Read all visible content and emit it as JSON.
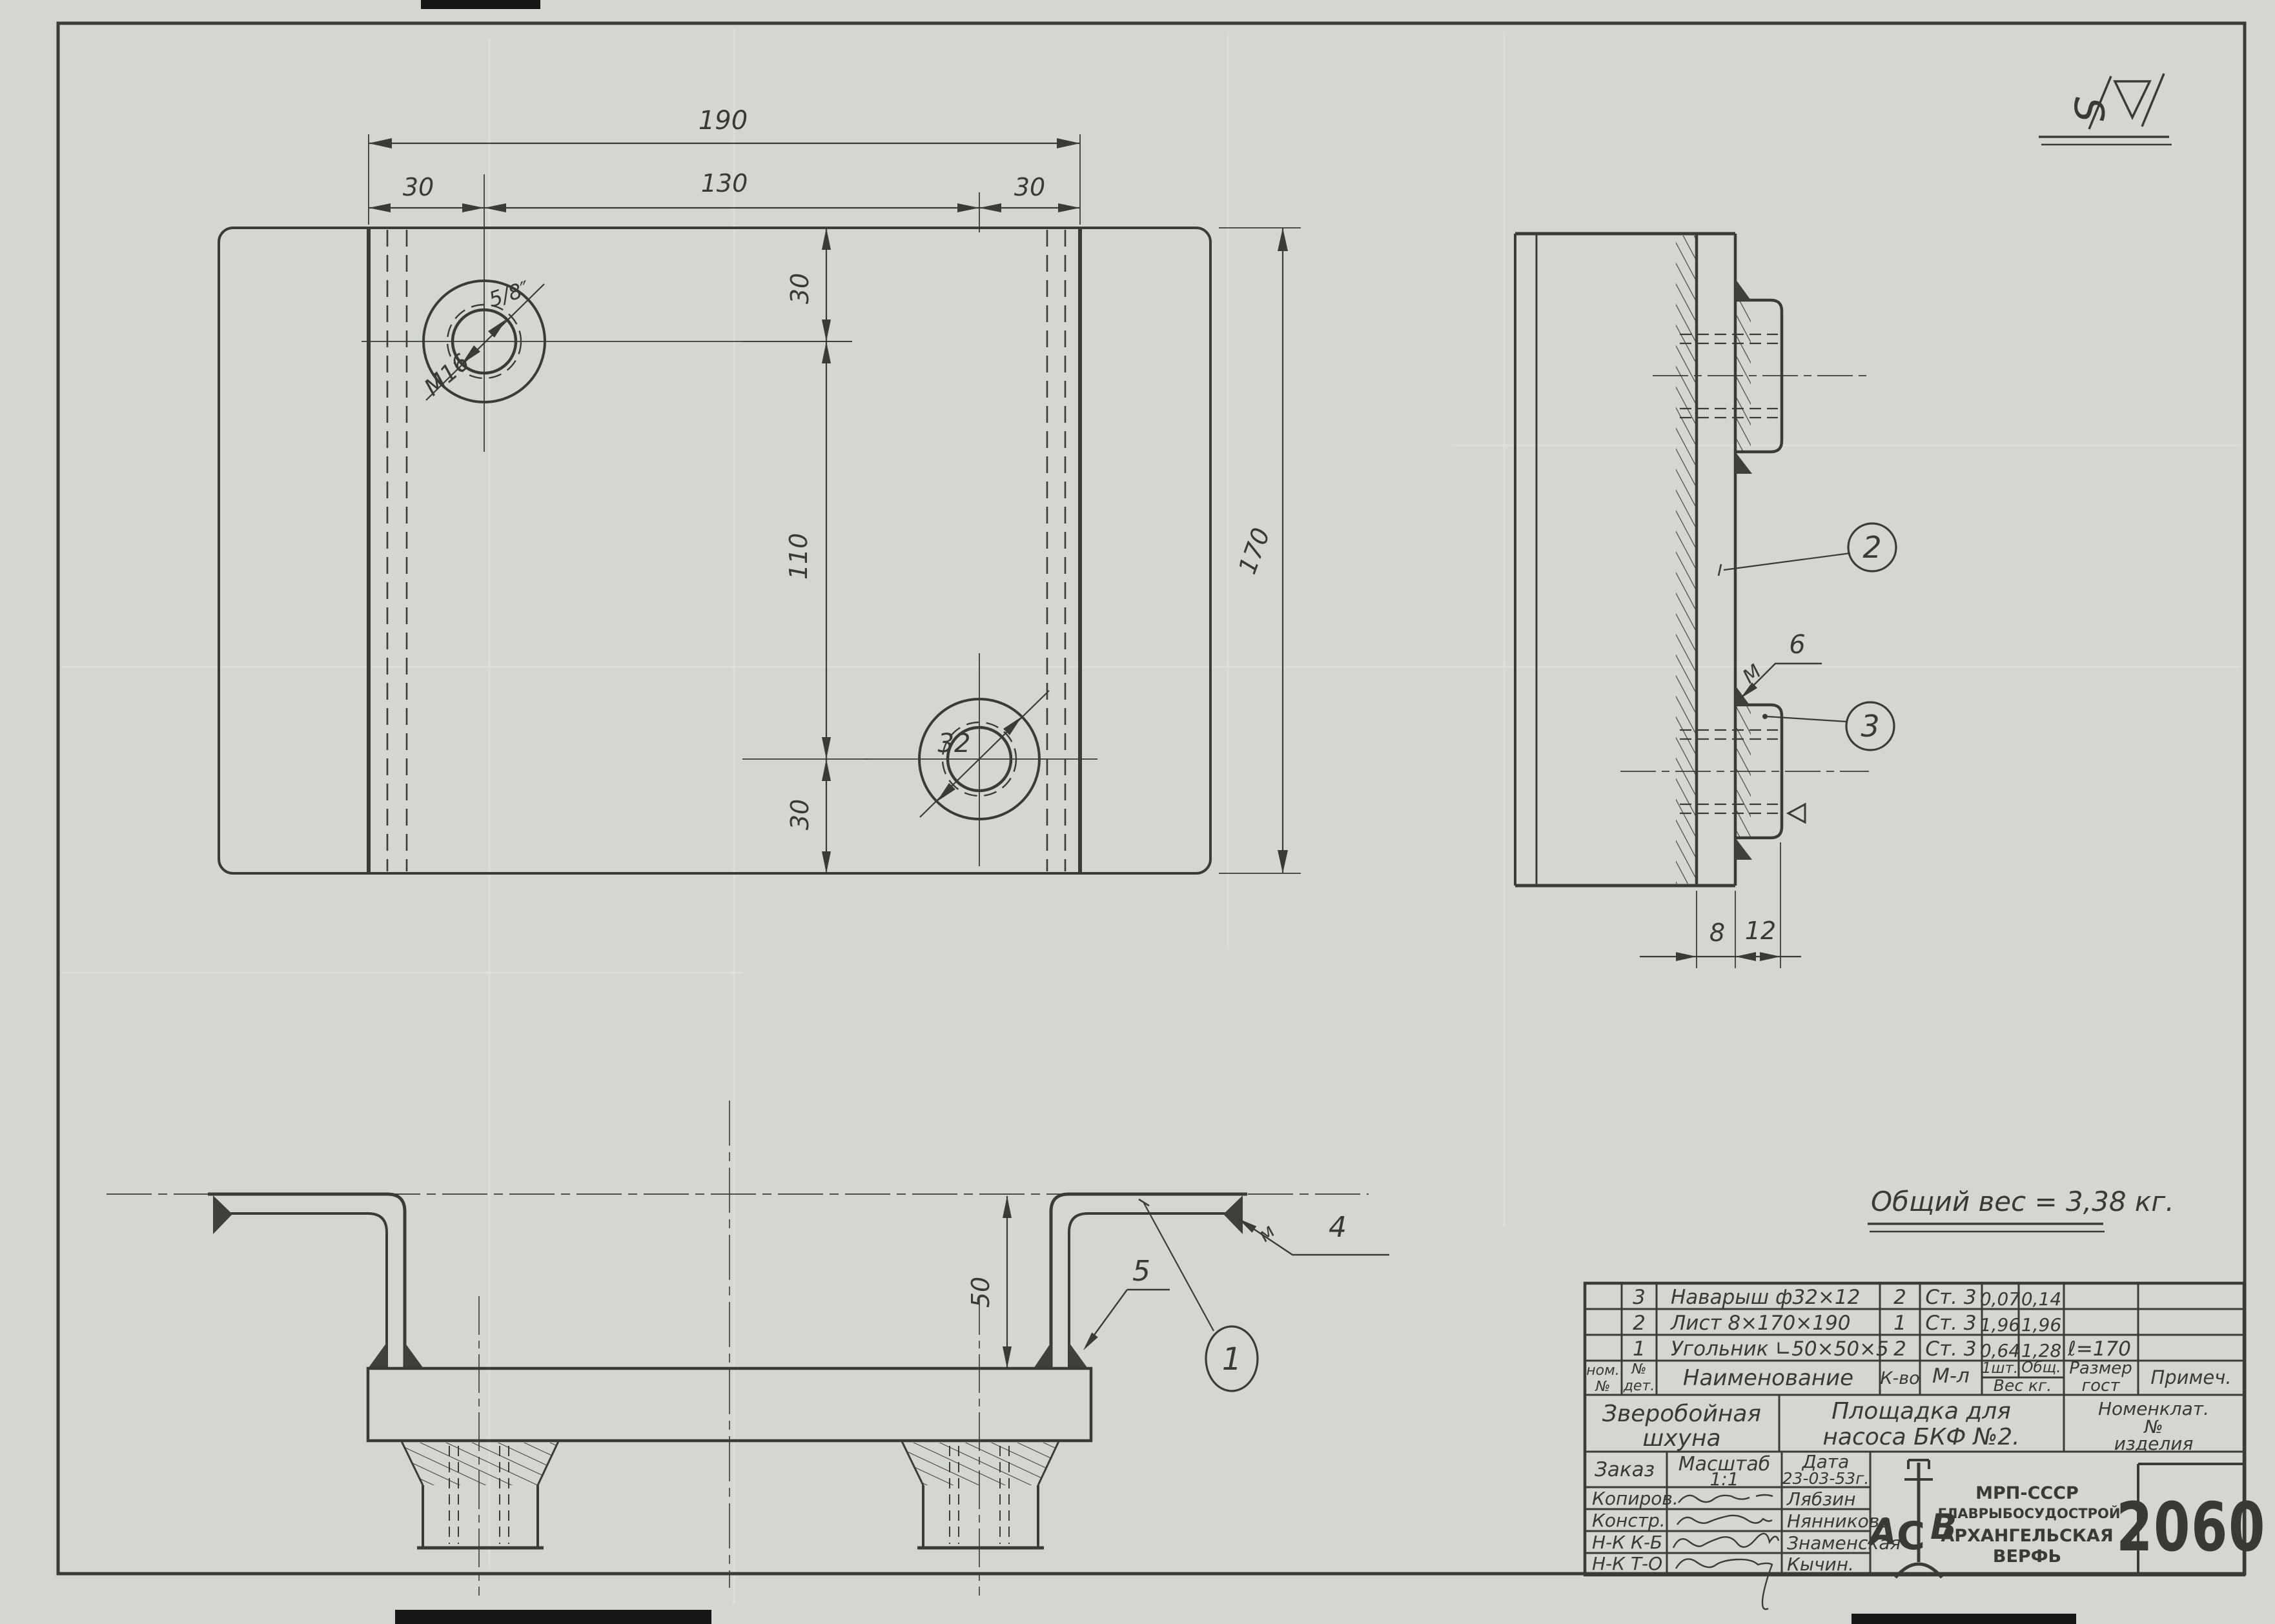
{
  "sheet": {
    "corner_mark_letter": "S",
    "note": "Общий вес = 3,38 кг."
  },
  "plan_view": {
    "dim_width_total": "190",
    "dim_width_left": "30",
    "dim_width_mid": "130",
    "dim_width_right": "30",
    "dim_height_top": "30",
    "dim_height_mid": "110",
    "dim_height_bottom": "30",
    "dim_height_total": "170",
    "hole_top_thread": "M16",
    "hole_top_inch": "5/8″",
    "hole_bottom_dia": "32"
  },
  "side_view": {
    "callout_plate": "2",
    "callout_boss": "3",
    "weld_letter": "M",
    "weld_size": "6",
    "dim_plate": "8",
    "dim_boss": "12"
  },
  "bottom_view": {
    "callout_angle": "1",
    "weld_letter": "м",
    "weld_size": "4",
    "callout_weld": "5",
    "dim_height": "50"
  },
  "title_block": {
    "parts": [
      {
        "num": "3",
        "name": "Наварыш  ф32×12",
        "qty": "2",
        "material": "Ст. 3",
        "weight_one": "0,07",
        "weight_total": "0,14",
        "size": ""
      },
      {
        "num": "2",
        "name": "Лист  8×170×190",
        "qty": "1",
        "material": "Ст. 3",
        "weight_one": "1,96",
        "weight_total": "1,96",
        "size": ""
      },
      {
        "num": "1",
        "name": "Угольник  ∟50×50×5",
        "qty": "2",
        "material": "Ст. 3",
        "weight_one": "0,64",
        "weight_total": "1,28",
        "size": "ℓ=170"
      }
    ],
    "headers": {
      "item_no_1": "ном.",
      "item_no_2": "№",
      "part_no_1": "№",
      "part_no_2": "дет.",
      "name": "Наименование",
      "qty": "К-во",
      "material": "М-л",
      "one_pc": "1шт.",
      "total": "Общ.",
      "weight": "Вес кг.",
      "size_1": "Размер",
      "size_2": "гост",
      "note": "Примеч."
    },
    "project_line1": "Зверобойная",
    "project_line2": "шхуна",
    "title_line1": "Площадка  для",
    "title_line2": "насоса  БКФ №2.",
    "nomen_line1": "Номенклат.",
    "nomen_line2": "№",
    "nomen_line3": "изделия",
    "order_label": "Заказ",
    "scale_label": "Масштаб",
    "scale_value": "1:1",
    "date_label": "Дата",
    "date_value": "23-03-53г.",
    "rows": [
      {
        "label": "Копиров.",
        "name": "Лябзин"
      },
      {
        "label": "Констр.",
        "name": "Нянникова"
      },
      {
        "label": "Н-К  К-Б",
        "name": "Знаменская"
      },
      {
        "label": "Н-К  Т-О",
        "name": "Кычин."
      }
    ],
    "org_line1": "МРП-СССР",
    "org_line2": "ГЛАВРЫБОСУДОСТРОЙ",
    "org_line3": "АРХАНГЕЛЬСКАЯ",
    "org_line4": "ВЕРФЬ",
    "emblem_a": "А",
    "emblem_c": "С",
    "emblem_b": "В",
    "number": "2060"
  }
}
